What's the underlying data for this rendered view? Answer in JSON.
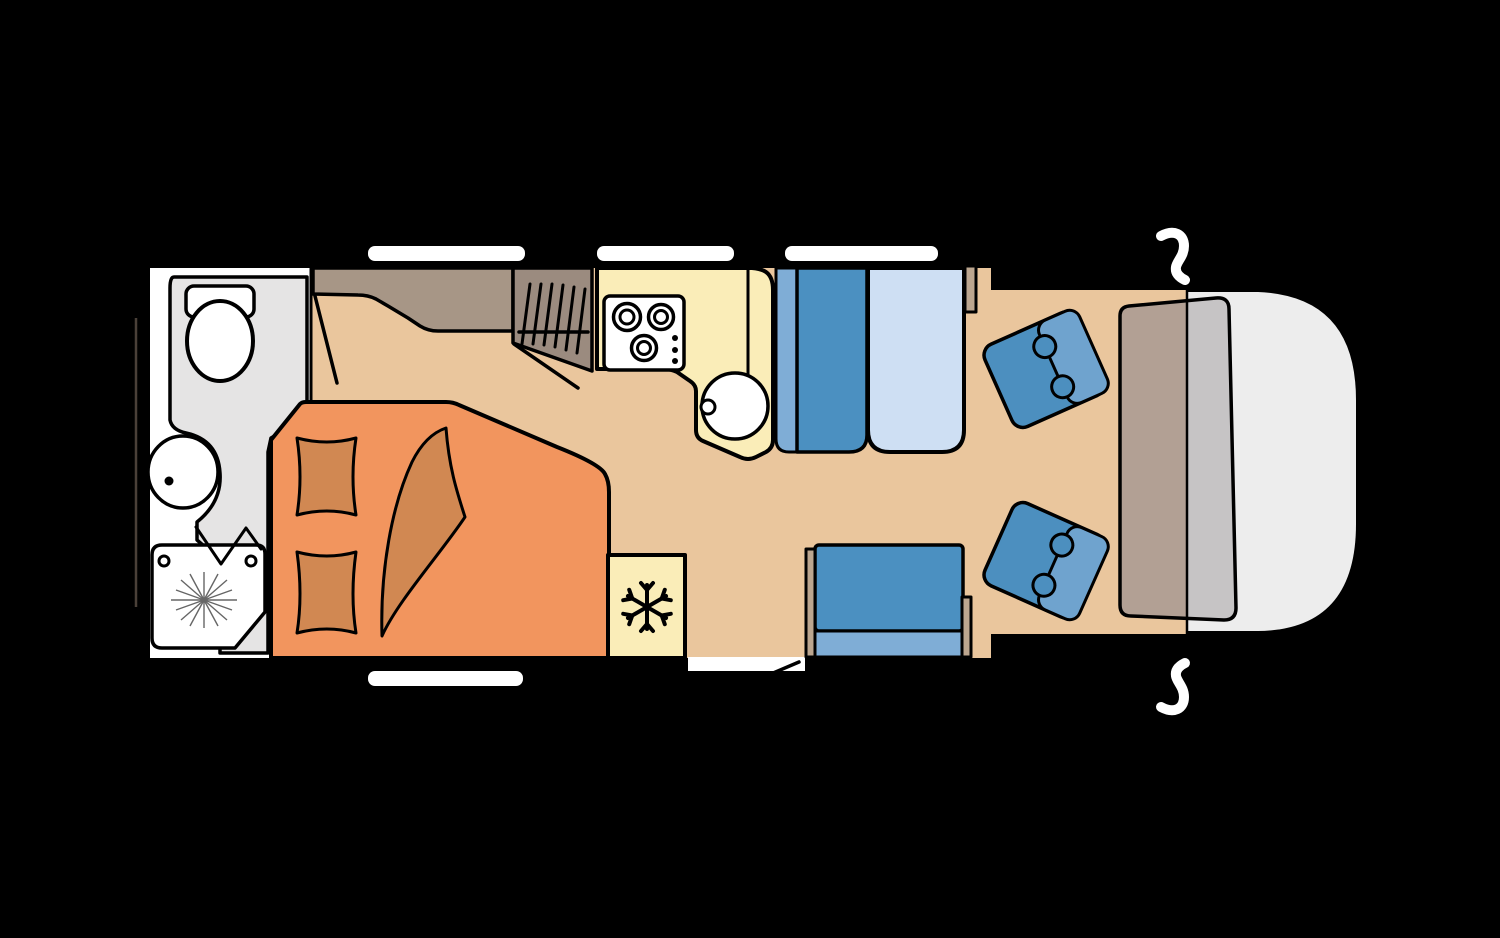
{
  "canvas": {
    "width": 1500,
    "height": 938,
    "background": "#000000"
  },
  "figure": {
    "kind": "motorhome-floor-plan",
    "orientation": "cab-on-right, rear-on-left",
    "rooms": [
      "bathroom",
      "rear-bed",
      "wardrobe",
      "kitchen",
      "dinette",
      "cab"
    ]
  },
  "icons": {
    "toilet": "toilet bowl with cistern",
    "washbasin": "oval basin with drain dot",
    "shower": "shower tray with spray starburst and folding door zigzag",
    "clothes-rail": "hanger rail with slanted hangers",
    "stove": "three-burner hob with control dots",
    "kitchen-sink": "round bowl with tap dot",
    "snowflake": "refrigerator freezer symbol",
    "door-swing": "open door diagonal line",
    "mirror": "exterior side mirror",
    "drop-down-bed": "overhead pull-down bed over cab seats"
  },
  "colors": {
    "background": "#000000",
    "outline": "#000000",
    "floor": "#EAC69D",
    "bathroom_floor": "#FFFFFF",
    "bathroom_wet": "#E5E4E4",
    "fixture_white": "#FFFFFF",
    "bed": "#F2955E",
    "bed_accent": "#D18852",
    "wardrobe": "#A79686",
    "closet": "#9B8B7F",
    "counter": "#FAEDB8",
    "appliance": "#FFFFFF",
    "seat_dark": "#4B90C1",
    "seat_light": "#7FADD6",
    "table": "#CEDFF3",
    "stub": "#BCA68F",
    "swivel_seat": "#4C8FBF",
    "swivel_back": "#6FA3CE",
    "drop_bed_inner": "#B2A094",
    "drop_bed_outer": "#C6C4C5",
    "cab_nose": "#EDEDED",
    "window": "#FFFFFF",
    "door_gap": "#FFFFFF",
    "mirror": "#FFFFFF",
    "rear_line": "#4A4038",
    "shower_ray": "#666666"
  }
}
